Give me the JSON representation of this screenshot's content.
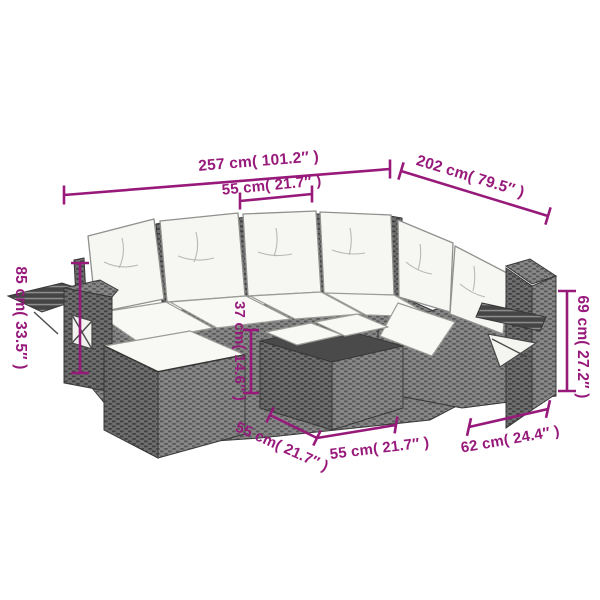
{
  "diagram": {
    "type": "product-dimension-diagram",
    "subject": "sectional garden sofa set with footstool and table",
    "accent_color": "#971a7b",
    "frame_color": "#7d7d7d",
    "frame_dark_color": "#686868",
    "cushion_color": "#f8f8f5",
    "outline_color": "#383838"
  },
  "labels": {
    "total_width": "257 cm( 101.2″ )",
    "total_depth": "202 cm( 79.5″ )",
    "seat_width": "55 cm( 21.7″ )",
    "left_arm_height": "85 cm( 33.5″ )",
    "right_back_height": "69 cm( 27.2″ )",
    "table_height": "37 cm( 14.6″ )",
    "table_side_left": "55 cm( 21.7″ )",
    "table_side_right": "55 cm( 21.7″ )",
    "right_seat_width": "62 cm( 24.4″ )"
  }
}
